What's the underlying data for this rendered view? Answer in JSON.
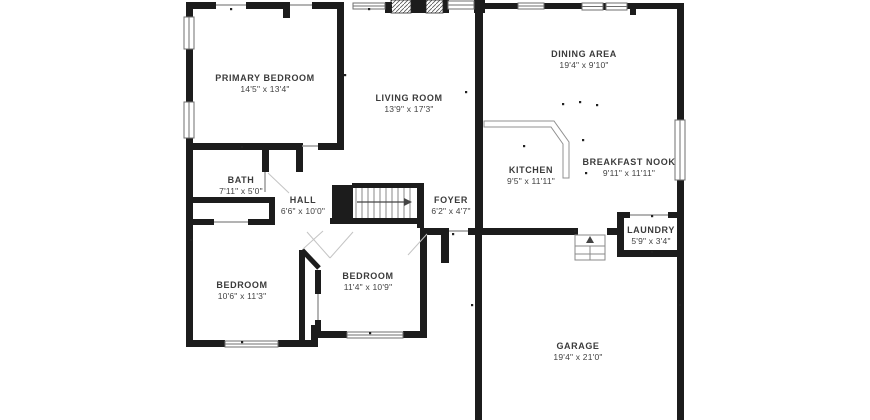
{
  "floorplan": {
    "type": "residential-floor-plan",
    "colors": {
      "wall": "#1c1c1c",
      "thin_line": "#9a9a9a",
      "text": "#3b3b3b",
      "background": "#ffffff"
    },
    "rooms": [
      {
        "name": "PRIMARY BEDROOM",
        "dims": "14'5\" x 13'4\""
      },
      {
        "name": "LIVING ROOM",
        "dims": "13'9\" x 17'3\""
      },
      {
        "name": "DINING AREA",
        "dims": "19'4\" x 9'10\""
      },
      {
        "name": "KITCHEN",
        "dims": "9'5\" x 11'11\""
      },
      {
        "name": "BREAKFAST NOOK",
        "dims": "9'11\" x 11'11\""
      },
      {
        "name": "BATH",
        "dims": "7'11\" x 5'0\""
      },
      {
        "name": "HALL",
        "dims": "6'6\" x 10'0\""
      },
      {
        "name": "FOYER",
        "dims": "6'2\" x 4'7\""
      },
      {
        "name": "LAUNDRY",
        "dims": "5'9\" x 3'4\""
      },
      {
        "name": "BEDROOM",
        "dims": "10'6\" x 11'3\""
      },
      {
        "name": "BEDROOM",
        "dims": "11'4\" x 10'9\""
      },
      {
        "name": "GARAGE",
        "dims": "19'4\" x 21'0\""
      }
    ]
  }
}
